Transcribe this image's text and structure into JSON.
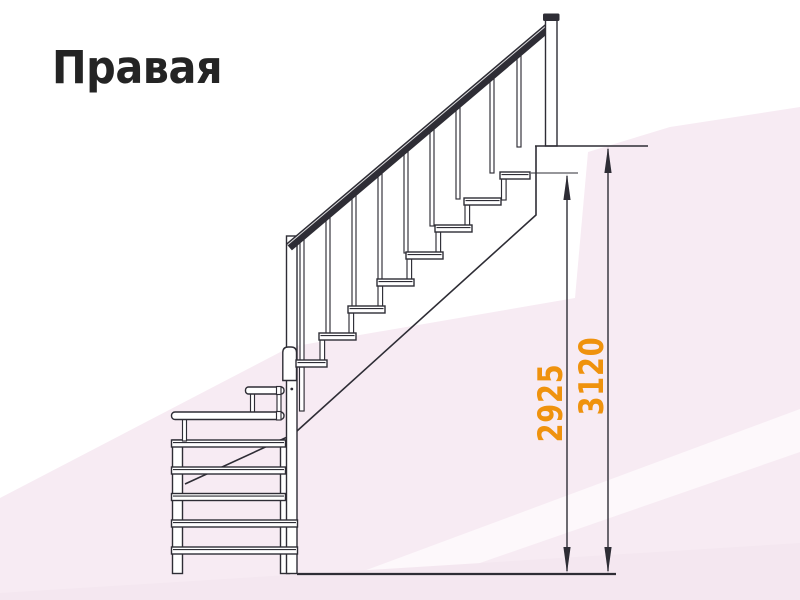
{
  "title": {
    "text": "Правая"
  },
  "dimensions": {
    "inner": {
      "value": "2925"
    },
    "outer": {
      "value": "3120"
    }
  },
  "colors": {
    "accent_orange": "#ef920d",
    "line_dark": "#2e2d35",
    "title_dark": "#242424",
    "background_pink": "#f7ebf3",
    "background_pink_deep": "#f4e7f0",
    "background_white_band": "#fdf8fb"
  },
  "figure": {
    "kind": "staircase-side-view",
    "main_flight_treads": 8,
    "winder_treads": 5,
    "balusters": 9
  }
}
